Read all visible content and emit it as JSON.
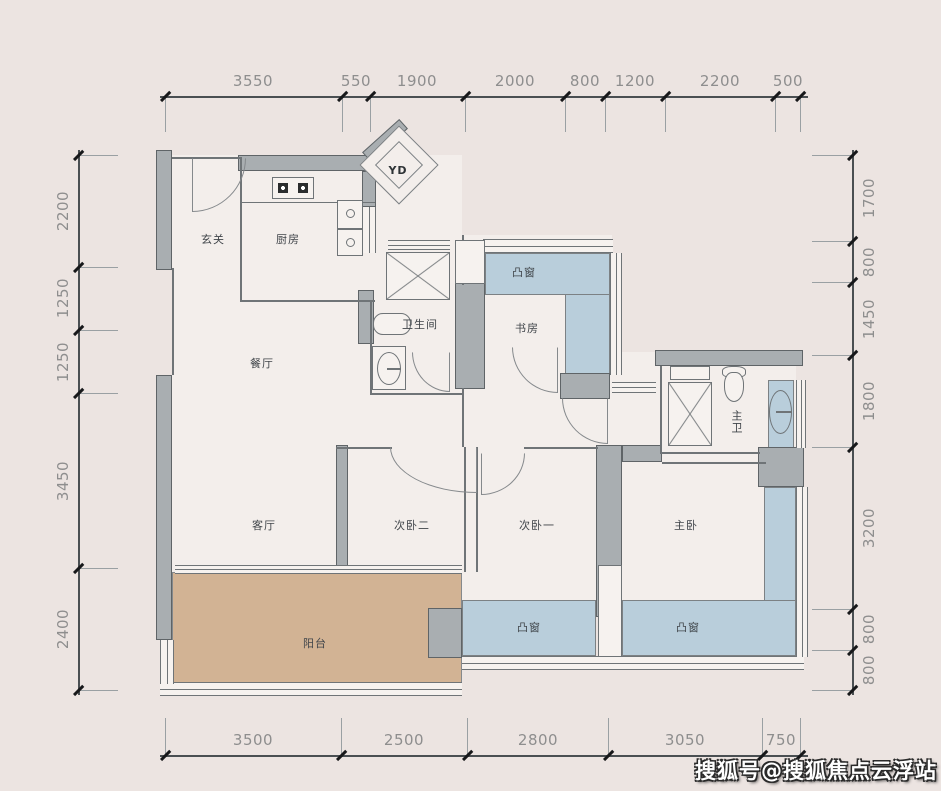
{
  "plan": {
    "watermark": "搜狐号@搜狐焦点云浮站",
    "rooms": {
      "entry": "玄关",
      "kitchen": "厨房",
      "dining": "餐厅",
      "bathroom": "卫生间",
      "study": "书房",
      "living": "客厅",
      "bedroom2": "次卧二",
      "bedroom1": "次卧一",
      "master_bedroom": "主卧",
      "master_bathroom": "主卫",
      "balcony": "阳台",
      "bay_window": "凸窗",
      "duct": "YD"
    },
    "dimensions_mm": {
      "top": [
        "3550",
        "550",
        "1900",
        "2000",
        "800",
        "1200",
        "2200",
        "500"
      ],
      "left": [
        "2200",
        "1250",
        "1250",
        "3450",
        "2400"
      ],
      "right": [
        "1700",
        "800",
        "1450",
        "1800",
        "3200",
        "800",
        "800"
      ],
      "bottom": [
        "3500",
        "2500",
        "2800",
        "3050",
        "750"
      ]
    },
    "colors": {
      "background": "#ece4e1",
      "floor": "#f3eeeb",
      "wall": "#a9aeb1",
      "bay_window": "#b9cedb",
      "balcony": "#d2b394",
      "line": "#7c8184",
      "dim_text": "#8e8e8e"
    }
  }
}
